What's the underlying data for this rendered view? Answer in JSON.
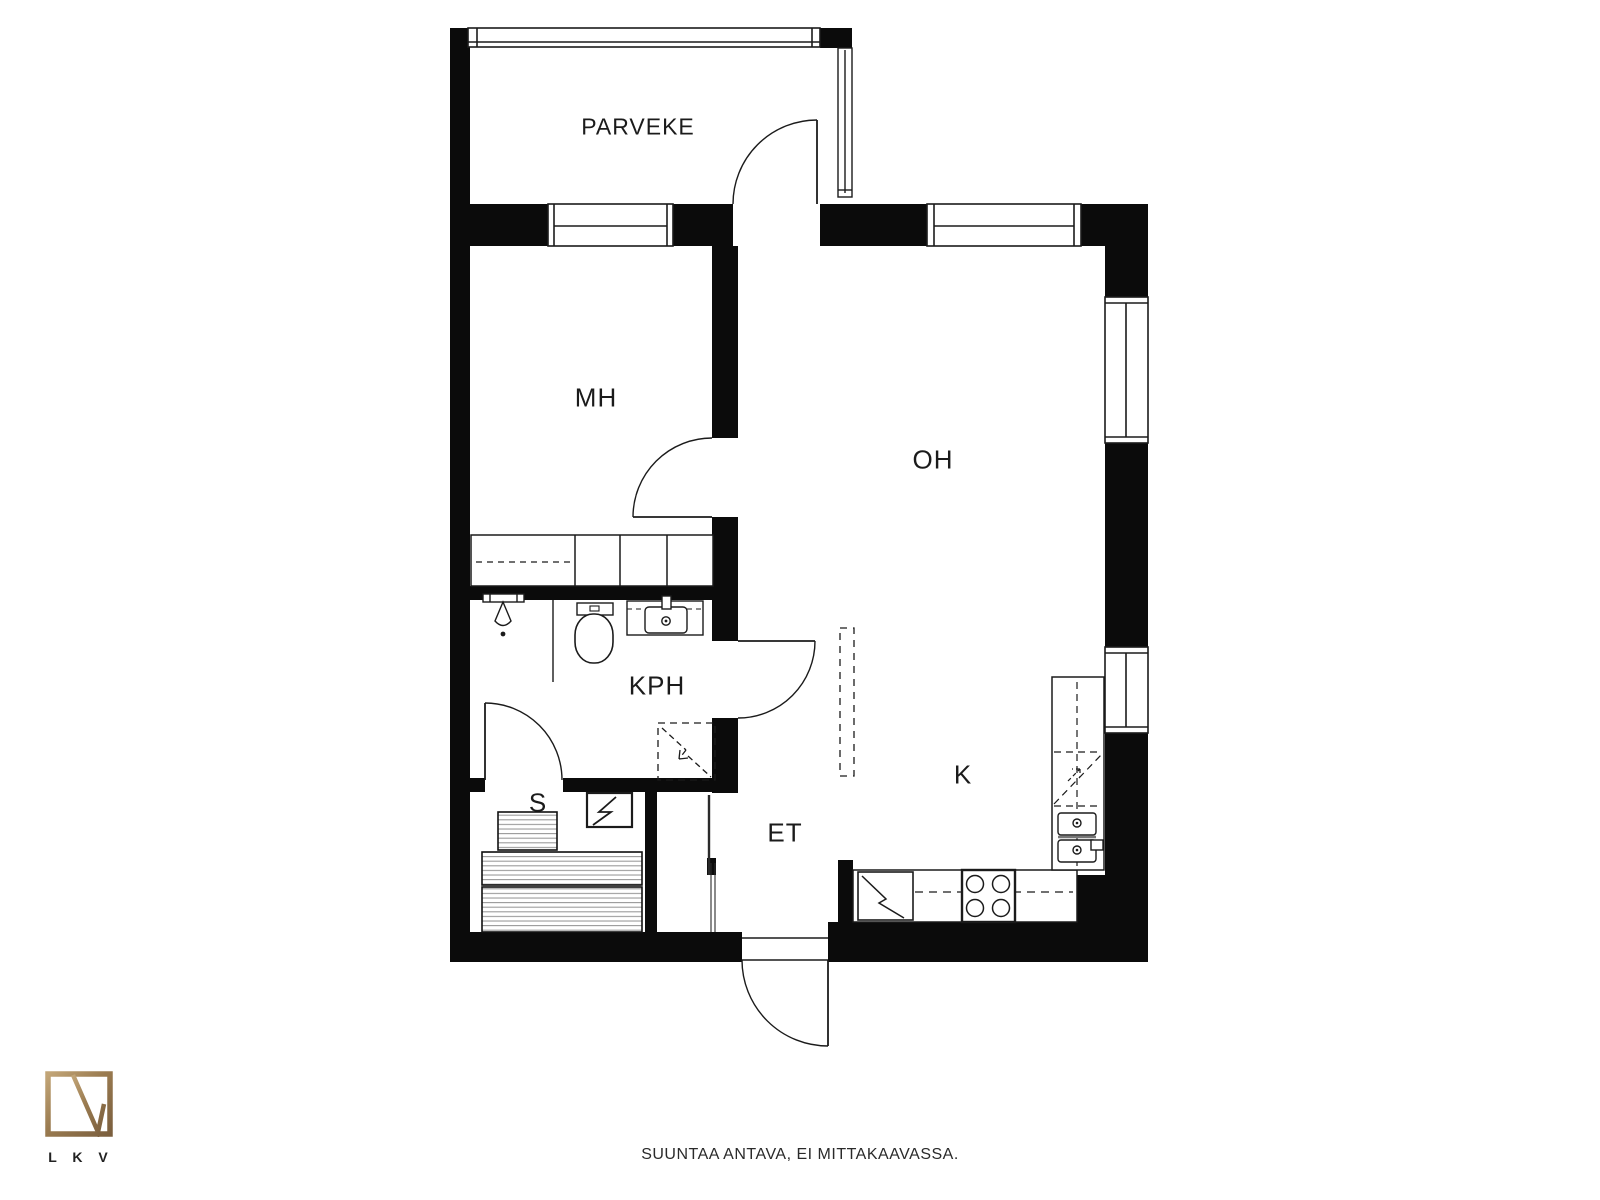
{
  "rooms": {
    "parveke": "PARVEKE",
    "mh": "MH",
    "oh": "OH",
    "kph": "KPH",
    "s": "S",
    "et": "ET",
    "k": "K"
  },
  "footer": {
    "disclaimer": "SUUNTAA ANTAVA, EI MITTAKAAVASSA."
  },
  "logo": {
    "caption": "L K V"
  },
  "colors": {
    "wall": "#0b0b0b",
    "line": "#1b1b1b",
    "bench_stripe": "#9a9a9a",
    "logo_gold": "#9a7b50",
    "background": "#ffffff"
  }
}
